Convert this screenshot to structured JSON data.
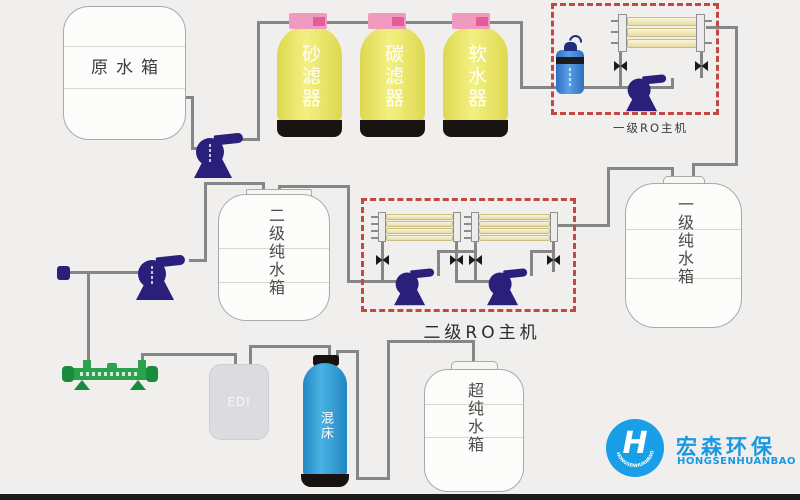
{
  "tanks": {
    "raw": {
      "label": "原水箱"
    },
    "stage2_pure": {
      "label": "二级纯水箱"
    },
    "stage1_pure": {
      "label": "一级纯水箱"
    },
    "ultra_pure": {
      "label": "超纯水箱"
    },
    "edi": {
      "label": "EDI"
    },
    "mixed_bed": {
      "label": "混床"
    }
  },
  "filters": [
    {
      "label": "砂滤器"
    },
    {
      "label": "碳滤器"
    },
    {
      "label": "软水器"
    }
  ],
  "ro_units": {
    "stage1": {
      "label": "一级RO主机"
    },
    "stage2": {
      "label": "二级RO主机"
    }
  },
  "logo": {
    "mark": "H",
    "name_cn": "宏森环保",
    "name_en": "HONGSENHUANBAO"
  },
  "colors": {
    "background": "#f0efed",
    "pipe_gray": "#868686",
    "dashed_box_red": "#c24840",
    "filter_yellow": "#e9e45c",
    "cap_pink": "#f19ac0",
    "pump_navy": "#2b1f7c",
    "membrane_cream": "#f5efc9",
    "mixed_bed_blue": "#2f9ad2",
    "uv_green": "#2ba24e",
    "logo_blue": "#199fe8"
  }
}
